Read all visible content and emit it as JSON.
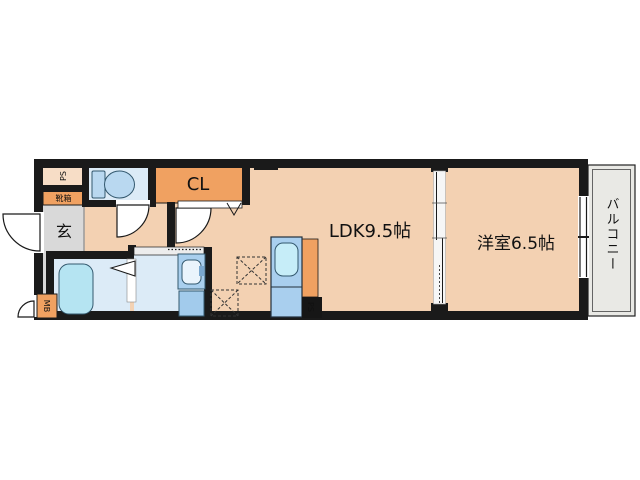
{
  "floorplan": {
    "rooms": {
      "ldk": {
        "label": "LDK9.5帖"
      },
      "western_room": {
        "label": "洋室6.5帖"
      },
      "balcony": {
        "label": "バルコニー"
      },
      "entrance": {
        "label": "玄"
      },
      "closet": {
        "label": "CL"
      },
      "shoe_cabinet": {
        "label": "靴箱"
      },
      "pipe_space_upper": {
        "label": "PS"
      },
      "pipe_space_kitchen": {
        "label": "PS"
      },
      "meter_box": {
        "label": "MB"
      }
    },
    "fixtures": [
      "toilet",
      "bathtub",
      "washbasin",
      "washing-machine-space",
      "kitchen-sink",
      "appliance-space-dashed"
    ],
    "colors": {
      "wall": "#1a1a1a",
      "floor": "#f3d1b2",
      "accent_orange": "#f0a161",
      "pipe_space_fill": "#f7ddc6",
      "wet_room": "#dcebf7",
      "fixture_blue": "#a9cfee",
      "bathtub_cyan": "#b5e4f2",
      "sink_cyan": "#c6edf8",
      "entrance_gray": "#d9d9d9",
      "balcony_gray": "#e9e9e5",
      "background": "#ffffff"
    }
  }
}
